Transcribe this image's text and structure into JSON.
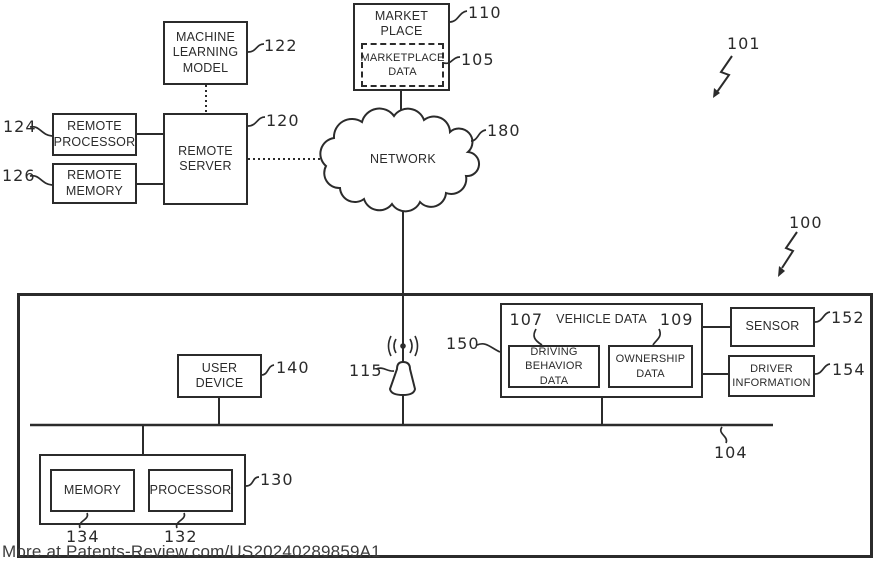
{
  "labels": {
    "machine_learning_model": "MACHINE\nLEARNING\nMODEL",
    "remote_processor": "REMOTE\nPROCESSOR",
    "remote_memory": "REMOTE\nMEMORY",
    "remote_server": "REMOTE\nSERVER",
    "marketplace": "MARKET\nPLACE",
    "marketplace_data": "MARKETPLACE\nDATA",
    "network": "NETWORK",
    "user_device": "USER\nDEVICE",
    "vehicle_data": "VEHICLE DATA",
    "driving_behavior_data": "DRIVING\nBEHAVIOR DATA",
    "ownership_data": "OWNERSHIP\nDATA",
    "sensor": "SENSOR",
    "driver_information": "DRIVER\nINFORMATION",
    "memory": "MEMORY",
    "processor": "PROCESSOR"
  },
  "refs": {
    "system_environment": "101",
    "vehicle_system": "100",
    "marketplace": "110",
    "marketplace_data": "105",
    "machine_learning_model": "122",
    "remote_server": "120",
    "remote_processor": "124",
    "remote_memory": "126",
    "network": "180",
    "user_device": "140",
    "antenna": "115",
    "vehicle_data": "150",
    "driving_behavior_data": "107",
    "ownership_data": "109",
    "sensor": "152",
    "driver_information": "154",
    "bus": "104",
    "onboard_computer": "130",
    "memory": "134",
    "processor": "132"
  },
  "watermark": "More at Patents-Review.com/US20240289859A1",
  "colors": {
    "ink": "#2b2b2b",
    "background": "#ffffff",
    "watermark": "#3c3c3c"
  }
}
